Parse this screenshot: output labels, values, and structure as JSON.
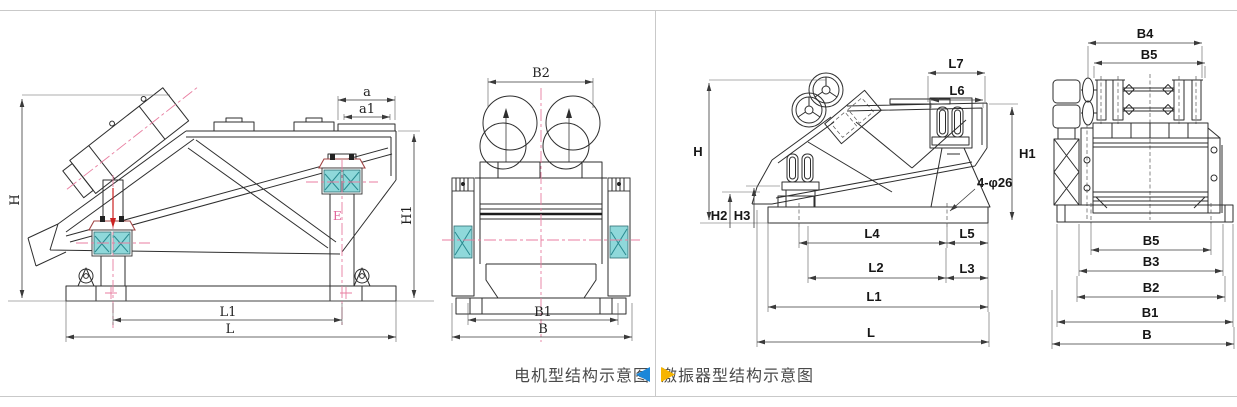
{
  "page": {
    "background": "#ffffff",
    "frame_color": "#c9c9c9"
  },
  "palette": {
    "line": "#2e2e2e",
    "centerline_pink": "#e87ea0",
    "accent_red": "#cc2222",
    "spring_fill": "#8fd8da",
    "spring_hatch": "#2a8a90",
    "caption_text": "#4a4a4a",
    "left_arrow_blue": "#1b87d9",
    "right_arrow_yellow": "#f7b500"
  },
  "captions": {
    "left": "电机型结构示意图",
    "right": "激振器型结构示意图"
  },
  "motor_side": {
    "labels": {
      "H": "H",
      "a": "a",
      "a1": "a1",
      "H1": "H1",
      "E": "E",
      "L1": "L1",
      "L": "L"
    }
  },
  "motor_front": {
    "labels": {
      "B2": "B2",
      "B1": "B1",
      "B": "B"
    }
  },
  "exciter_side": {
    "labels": {
      "L7": "L7",
      "L6": "L6",
      "H": "H",
      "H1": "H1",
      "H2": "H2",
      "H3": "H3",
      "bolt_note": "4-φ26",
      "L4": "L4",
      "L5": "L5",
      "L2": "L2",
      "L3": "L3",
      "L1": "L1",
      "L": "L"
    }
  },
  "exciter_front": {
    "labels": {
      "B4": "B4",
      "B5_top": "B5",
      "B5_bot": "B5",
      "B3": "B3",
      "B2": "B2",
      "B1": "B1",
      "B": "B"
    }
  }
}
